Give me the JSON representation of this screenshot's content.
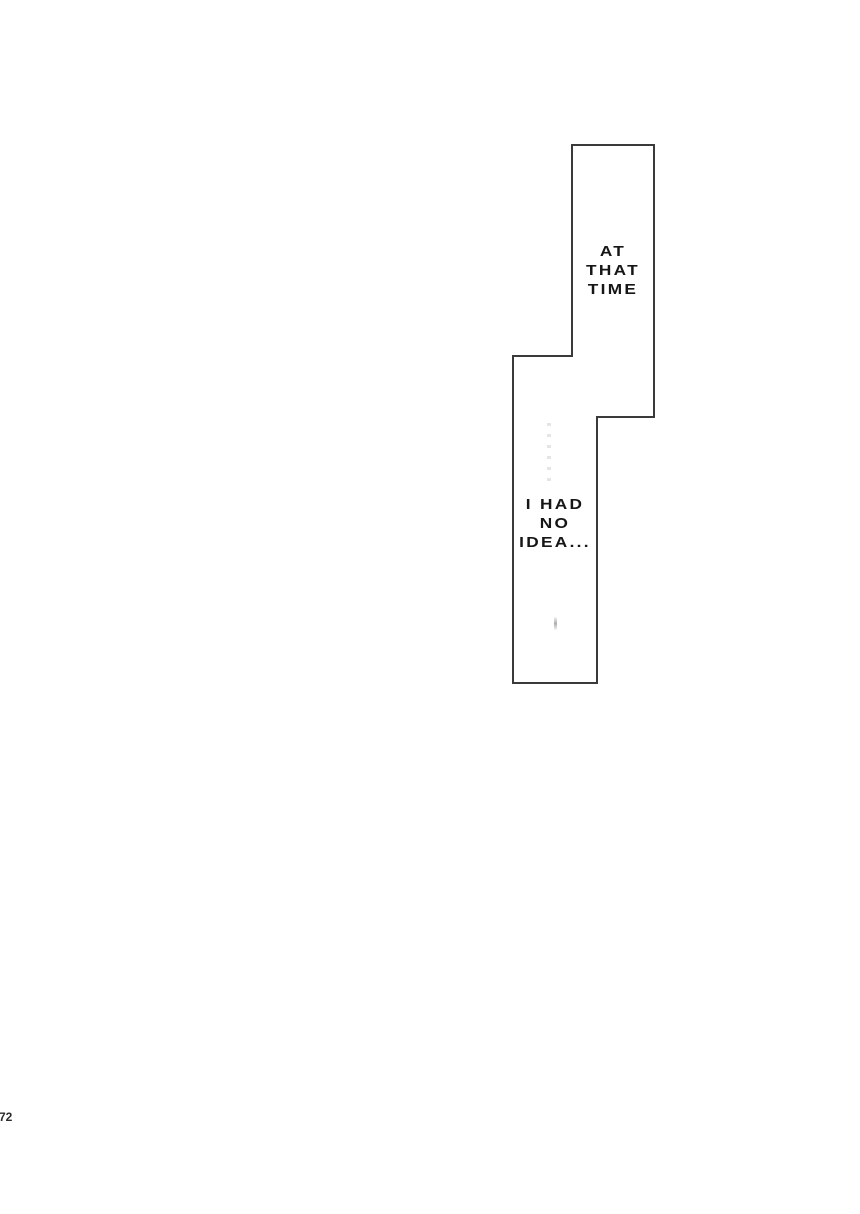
{
  "page": {
    "background_color": "#ffffff",
    "page_number": "72"
  },
  "panel": {
    "border_color": "#3a3a3a",
    "fill_color": "#ffffff"
  },
  "bubbles": [
    {
      "name": "top-bubble",
      "lines": [
        "AT",
        "THAT",
        "TIME"
      ]
    },
    {
      "name": "bottom-bubble",
      "lines": [
        "I HAD",
        "NO",
        "IDEA..."
      ]
    }
  ]
}
